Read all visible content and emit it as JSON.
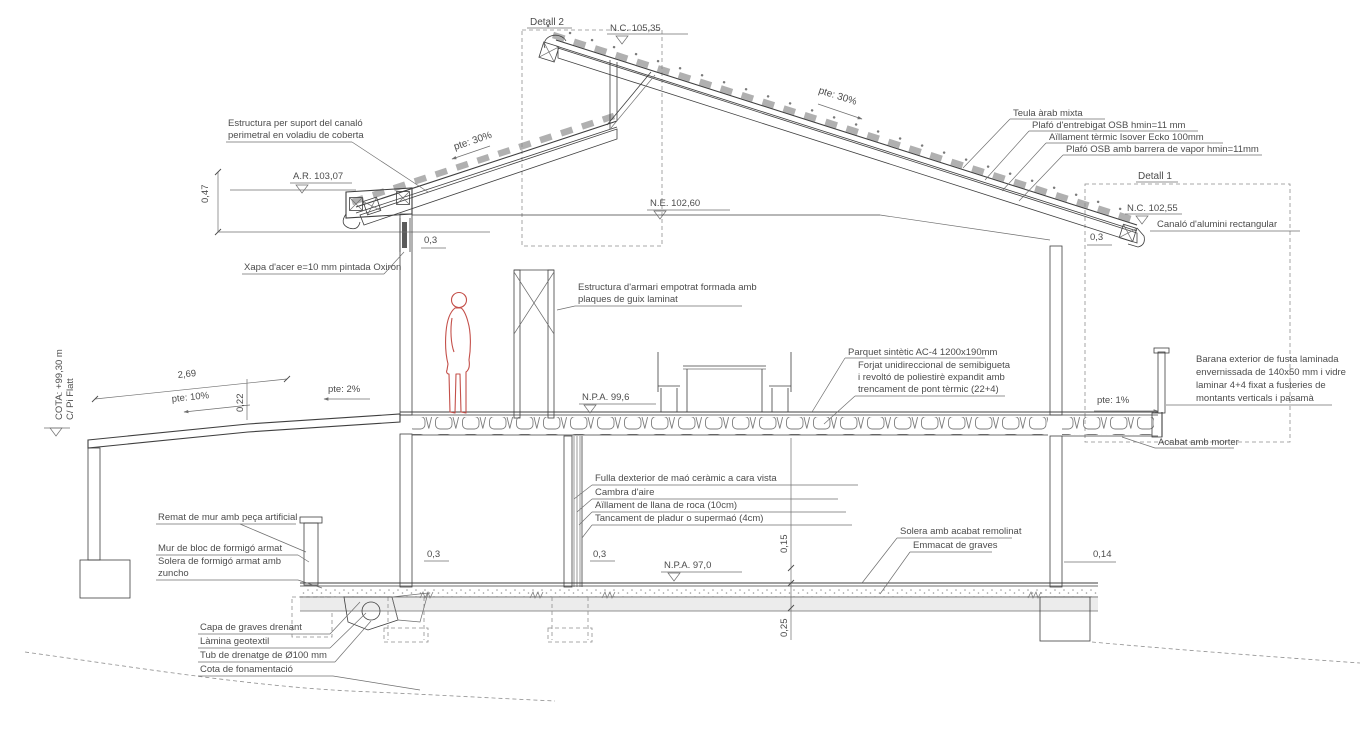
{
  "drawing": {
    "details": {
      "detall1": "Detall 1",
      "detall2": "Detall 2"
    },
    "levels": {
      "nc_ridge": "N.C. 105,35",
      "ar_eave": "A.R. 103,07",
      "ne_ceiling": "N.E. 102,60",
      "nc_gutter": "N.C. 102,55",
      "npa_floor": "N.P.A. 99,6",
      "npa_ground": "N.P.A. 97,0",
      "street_cota_line1": "COTA: +99,30 m",
      "street_cota_line2": "C/ Pi Flatt"
    },
    "slopes": {
      "roof_left": "pte: 30%",
      "roof_right": "pte: 30%",
      "ramp": "pte: 10%",
      "terrace": "pte: 2%",
      "balcony": "pte: 1%"
    },
    "dimensions": {
      "d047": "0,47",
      "d269": "2,69",
      "d022": "0,22",
      "d03": "0,3",
      "d015": "0,15",
      "d025": "0,25",
      "d014": "0,14"
    },
    "callouts": {
      "canalo_structure": [
        "Estructura per suport del canaló",
        "perimetral en voladiu de coberta"
      ],
      "teula": "Teula àrab mixta",
      "plafo_entrebigat": "Plafó d'entrebigat OSB hmin=11 mm",
      "aillament_coberta": "Aïllament tèrmic Isover Ecko 100mm",
      "plafo_osb": "Plafó OSB amb barrera de vapor hmin=11mm",
      "canalo_alumini": "Canaló d'alumini rectangular",
      "xapa_acer": "Xapa d'acer e=10 mm pintada Oxiron",
      "armari": [
        "Estructura d'armari empotrat formada amb",
        "plaques de guix laminat"
      ],
      "parquet": "Parquet sintètic AC-4 1200x190mm",
      "forjat": [
        "Forjat unidireccional de semibigueta",
        "i revoltó de poliestirè expandit amb",
        "trencament de pont tèrmic (22+4)"
      ],
      "barana": [
        "Barana exterior de fusta laminada",
        "envernissada de 140x50 mm i vidre",
        "laminar 4+4 fixat a fusteries de",
        "montants verticals i pasamà"
      ],
      "acabat_morter": "Acabat amb morter",
      "fulla_exterior": "Fulla dexterior de maó ceràmic a cara vista",
      "cambra_aire": "Cambra d'aire",
      "aillament_roca": "Aïllament de llana de roca (10cm)",
      "tancament_pladur": "Tancament de pladur o supermaó (4cm)",
      "solera_remolinat": "Solera amb acabat remolinat",
      "emmacat": "Emmacat de graves",
      "remat_mur": "Remat de mur amb peça artificial",
      "mur_bloc": "Mur de bloc de formigó armat",
      "solera_zuncho": [
        "Solera de formigó armat amb",
        "zuncho"
      ],
      "capa_graves": "Capa de graves drenant",
      "lamina_geotextil": "Làmina geotextil",
      "tub_drenatge": "Tub de drenatge de Ø100 mm",
      "cota_fonamentacio": "Cota de fonamentació"
    },
    "colors": {
      "line_dark": "#3f3f3f",
      "line_light": "#6f6f6f",
      "hatch": "#a5a5a5",
      "figure_red": "#c4504a",
      "terrain": "#ececec"
    }
  }
}
